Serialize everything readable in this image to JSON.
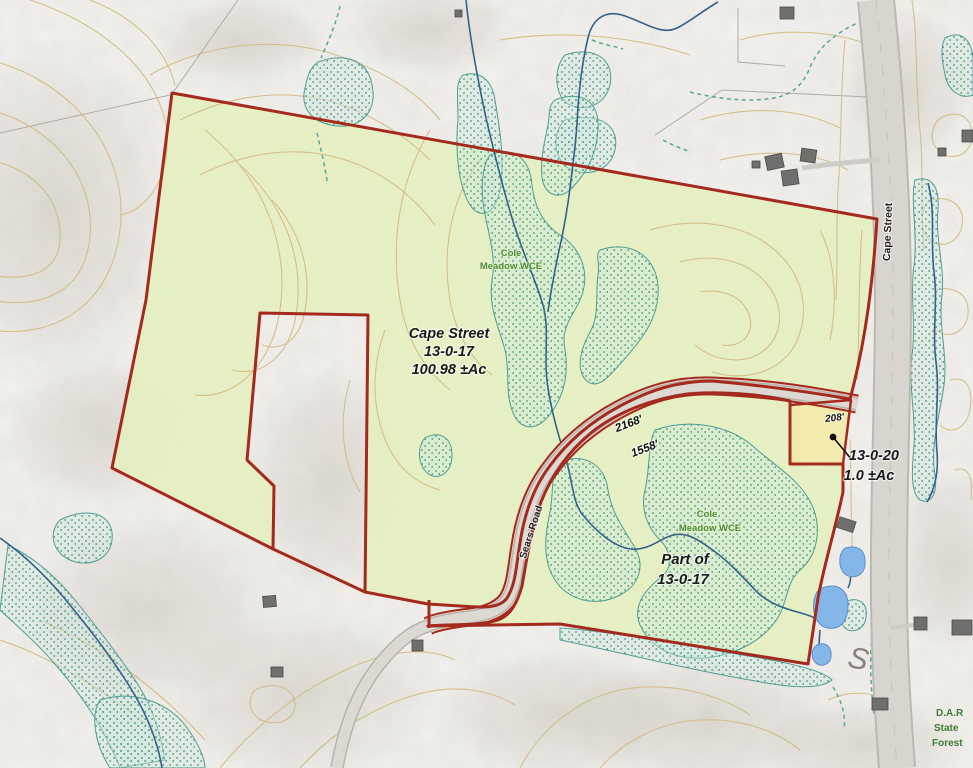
{
  "map": {
    "region_labels": {
      "main_parcel": {
        "line1": "Cape Street",
        "line2": "13-0-17",
        "line3": "100.98 ±Ac"
      },
      "south_parcel": {
        "line1": "Part of",
        "line2": "13-0-17"
      },
      "small_parcel": {
        "line1": "13-0-20",
        "line2": "1.0 ±Ac",
        "edge_dimension": "208'"
      },
      "easement_north": {
        "line1": "Cole",
        "line2": "Meadow WCE"
      },
      "easement_south": {
        "line1": "Cole",
        "line2": "Meadow WCE"
      },
      "state_forest": {
        "line1": "D.A.R",
        "line2": "State",
        "line3": "Forest"
      },
      "terrain_mark": "S"
    },
    "road_labels": {
      "sears_road": "Sears Road",
      "cape_street": "Cape Street",
      "frontage_north": "2168'",
      "frontage_south": "1558'"
    },
    "colors": {
      "parcel_boundary_red": "#A42A1E",
      "parcel_fill_green": "#E4F0BD",
      "small_parcel_fill_yellow": "#F2EAA9",
      "road_fill": "#D8D5CF",
      "contour_tan": "#D4BA80",
      "stream_blue": "#33628C",
      "wetland_teal": "#4F9E92",
      "pond_blue": "#85B6EA",
      "label_green": "#4C8B3F"
    }
  }
}
